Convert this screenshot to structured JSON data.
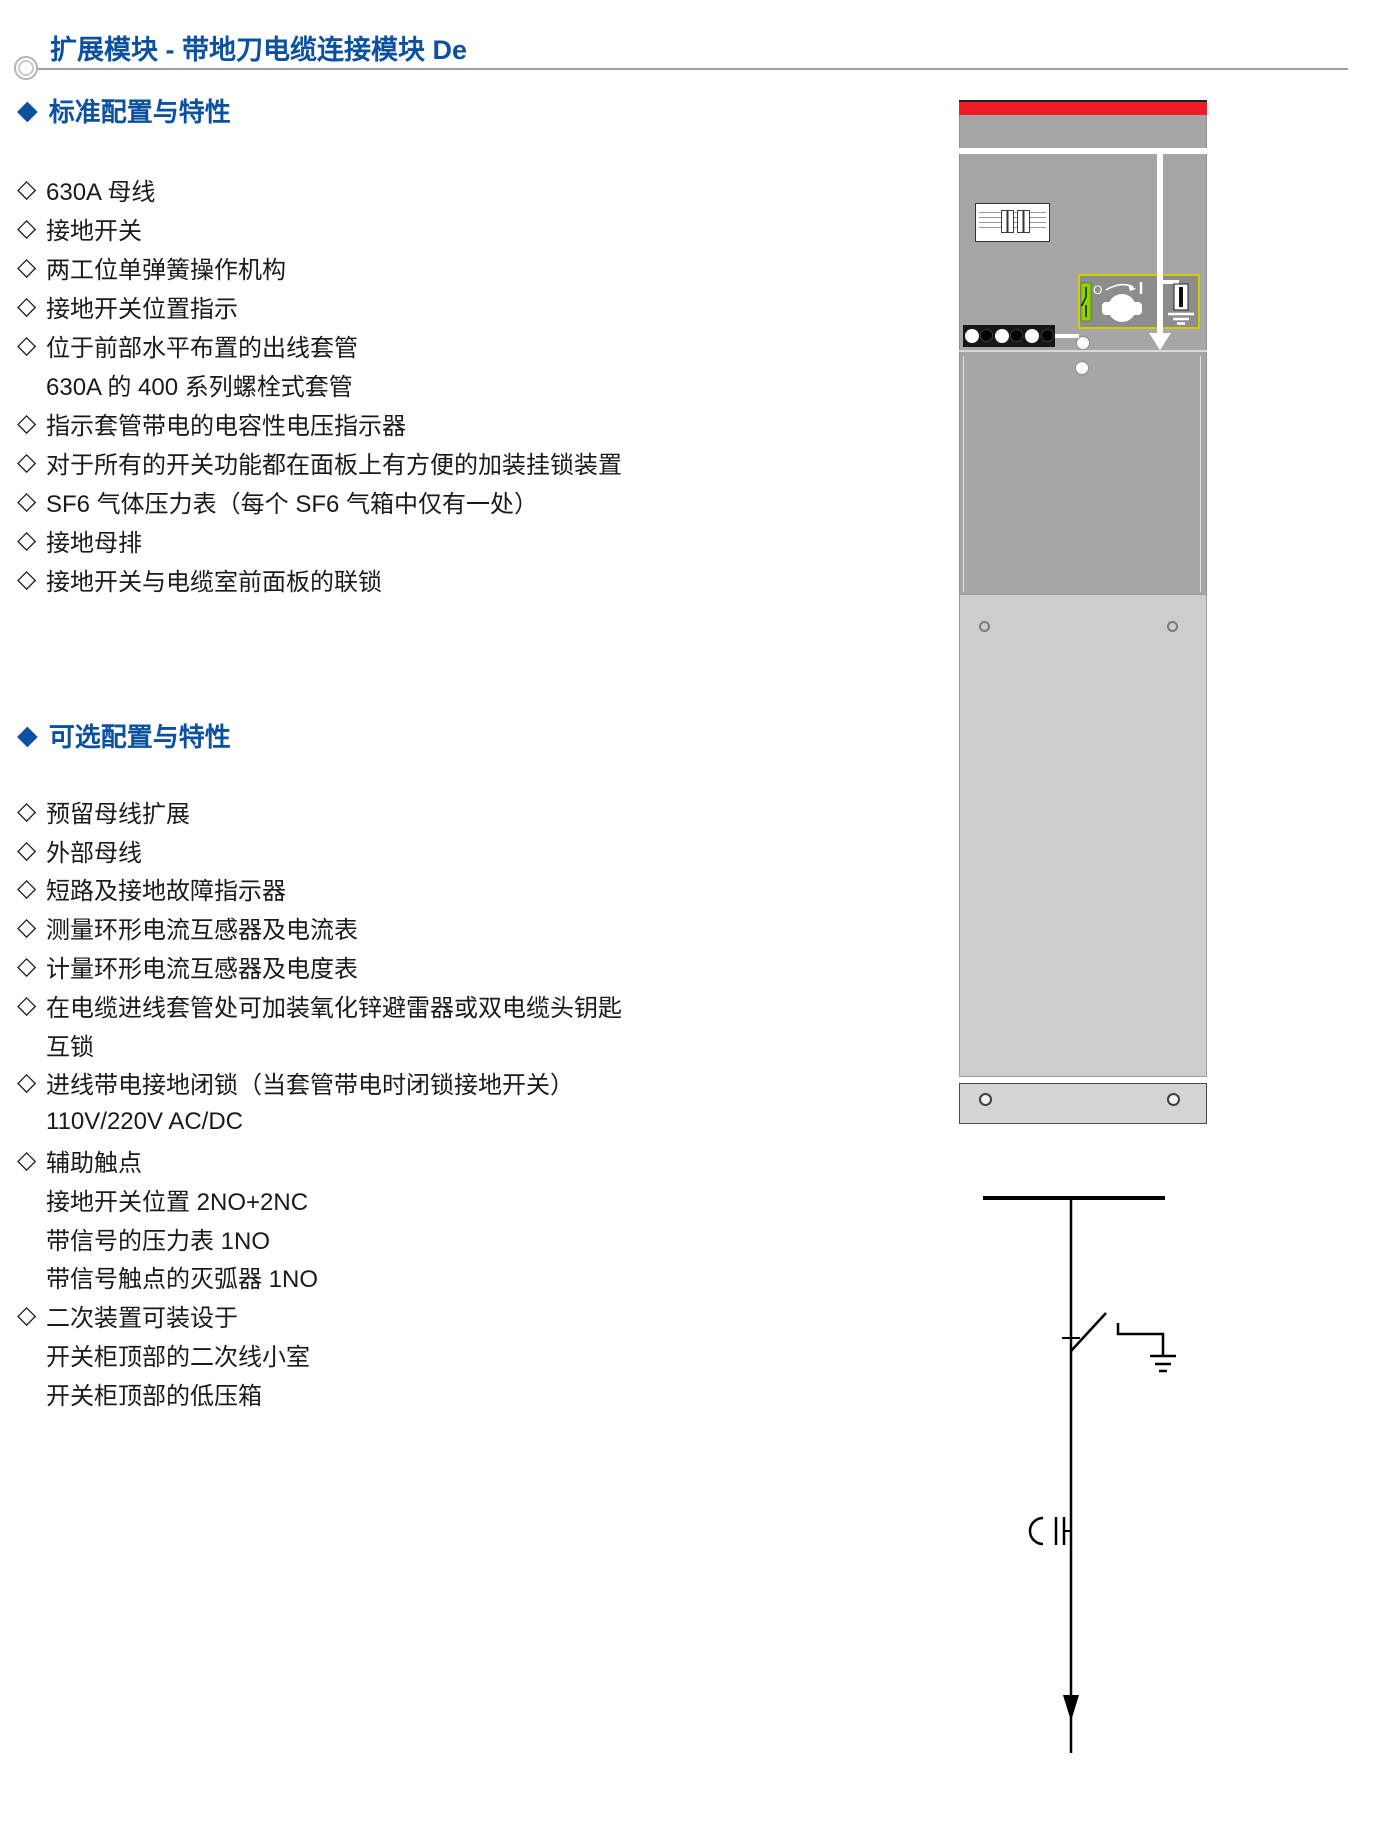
{
  "page": {
    "title": "扩展模块 - 带地刀电缆连接模块 De"
  },
  "glyphs": {
    "section_marker": "◆",
    "item_bullet": "◇"
  },
  "colors": {
    "accent_blue": "#0b51a0",
    "cabinet_red_strip": "#ee1c25",
    "cabinet_gray": "#a6a6a6",
    "cable_panel_gray": "#cdcdcd",
    "operation_box_gray": "#8d8d8d",
    "operation_box_border_yellow": "#cfcf00",
    "position_indicator_green": "#8fd400"
  },
  "sections": [
    {
      "heading": "标准配置与特性",
      "items": [
        {
          "text": "630A 母线"
        },
        {
          "text": "接地开关"
        },
        {
          "text": "两工位单弹簧操作机构"
        },
        {
          "text": "接地开关位置指示"
        },
        {
          "text": "位于前部水平布置的出线套管",
          "sub": [
            "630A 的 400 系列螺栓式套管"
          ]
        },
        {
          "text": "指示套管带电的电容性电压指示器"
        },
        {
          "text": "对于所有的开关功能都在面板上有方便的加装挂锁装置"
        },
        {
          "text": "SF6 气体压力表（每个 SF6 气箱中仅有一处）"
        },
        {
          "text": "接地母排"
        },
        {
          "text": "接地开关与电缆室前面板的联锁"
        }
      ]
    },
    {
      "heading": "可选配置与特性",
      "items": [
        {
          "text": "预留母线扩展"
        },
        {
          "text": "外部母线"
        },
        {
          "text": "短路及接地故障指示器"
        },
        {
          "text": "测量环形电流互感器及电流表"
        },
        {
          "text": "计量环形电流互感器及电度表"
        },
        {
          "text": "在电缆进线套管处可加装氧化锌避雷器或双电缆头钥匙",
          "sub": [
            "互锁"
          ]
        },
        {
          "text": "进线带电接地闭锁（当套管带电时闭锁接地开关）",
          "sub": [
            "110V/220V AC/DC"
          ]
        },
        {
          "text": "辅助触点",
          "sub": [
            "接地开关位置 2NO+2NC",
            "带信号的压力表 1NO",
            "带信号触点的灭弧器 1NO"
          ]
        },
        {
          "text": "二次装置可装设于",
          "sub": [
            "开关柜顶部的二次线小室",
            "开关柜顶部的低压箱"
          ]
        }
      ]
    }
  ],
  "figures": {
    "cabinet": {
      "knob_left_mark": "O",
      "knob_right_mark": "|"
    }
  }
}
